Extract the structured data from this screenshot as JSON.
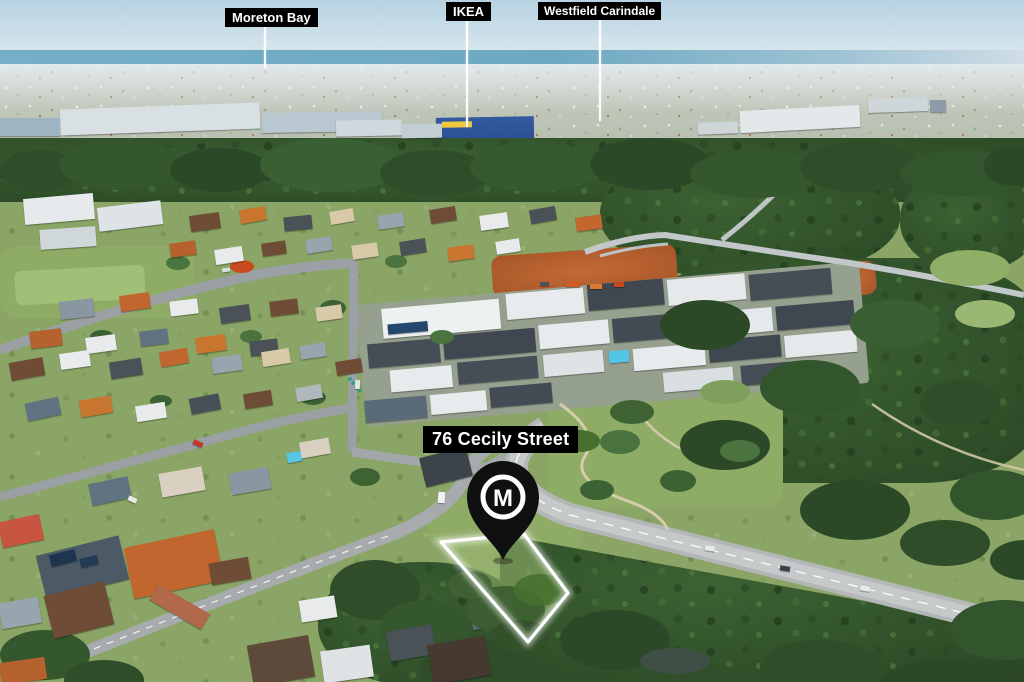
{
  "meta": {
    "type": "annotated aerial drone photograph",
    "subject": "residential land parcel marketing image"
  },
  "landmark_labels": [
    {
      "name": "moreton-bay",
      "text": "Moreton Bay"
    },
    {
      "name": "ikea",
      "text": "IKEA"
    },
    {
      "name": "westfield-carindale",
      "text": "Westfield Carindale"
    }
  ],
  "property": {
    "address": "76 Cecily Street",
    "marker_letter": "M"
  },
  "colors": {
    "label_background": "#000000",
    "label_text": "#ffffff",
    "marker_pin": "#101010",
    "marker_ring": "#ffffff",
    "boundary_outline": "#ffffff",
    "sky": "#bdd6e4",
    "sea": "#72abc4",
    "vegetation_dark": "#2f4f29",
    "lawn_green": "#8aa565",
    "road_gray": "#a7abad",
    "ikea_blue": "#2b4f94",
    "ikea_yellow": "#f0c83c",
    "dirt_orange": "#b4602f"
  }
}
